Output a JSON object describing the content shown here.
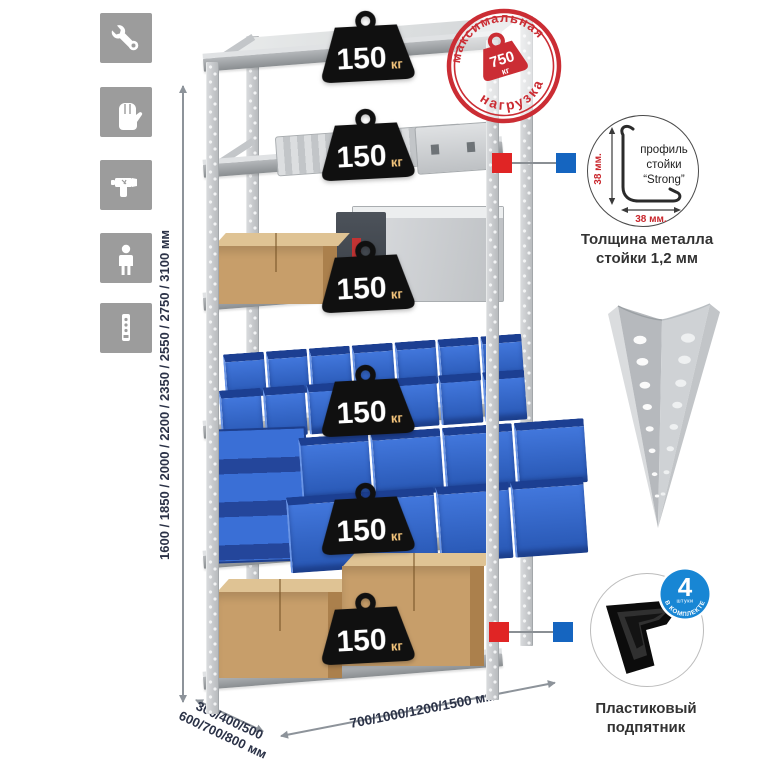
{
  "left_rail": {
    "tiles": [
      {
        "icon": "wrench-icon"
      },
      {
        "icon": "gloves-icon"
      },
      {
        "icon": "drill-icon"
      },
      {
        "icon": "person-icon"
      },
      {
        "icon": "rack-post-icon"
      }
    ],
    "tile_color": "#9c9c9c"
  },
  "dimensions": {
    "height_label": "1600 / 1850 / 2000 / 2200 / 2350 / 2550 / 2750 / 3100 мм",
    "depth_line1": "300/400/500",
    "depth_line2": "600/700/800 мм",
    "width_label": "700/1000/1200/1500 мм"
  },
  "max_load_stamp": {
    "arc_top": "максимальная",
    "arc_bottom": "нагрузка",
    "value": "750",
    "unit": "кг",
    "color": "#cb2d34"
  },
  "shelves": [
    {
      "load": "150",
      "unit": "кг"
    },
    {
      "load": "150",
      "unit": "кг"
    },
    {
      "load": "150",
      "unit": "кг"
    },
    {
      "load": "150",
      "unit": "кг"
    },
    {
      "load": "150",
      "unit": "кг"
    },
    {
      "load": "150",
      "unit": "кг"
    }
  ],
  "profile_detail": {
    "name_line1": "профиль",
    "name_line2": "стойки",
    "name_line3": "“Strong”",
    "dim_vertical": "38 мм.",
    "dim_horizontal": "38 мм.",
    "caption_line1": "Толщина металла",
    "caption_line2": "стойки 1,2 мм"
  },
  "foot_detail": {
    "badge_value": "4",
    "badge_sub": "штуки",
    "badge_arc": "в комплекте",
    "caption_line1": "Пластиковый",
    "caption_line2": "подпятник",
    "badge_color": "#1886d4"
  },
  "colors": {
    "accent_red": "#cb2d34",
    "connector_red": "#e02525",
    "connector_blue": "#1565c0",
    "bin_blue": "#2e62c6",
    "metal_gray": "#d2d5d8",
    "cardboard": "#c79e6a",
    "icon_tile_gray": "#9c9c9c"
  }
}
